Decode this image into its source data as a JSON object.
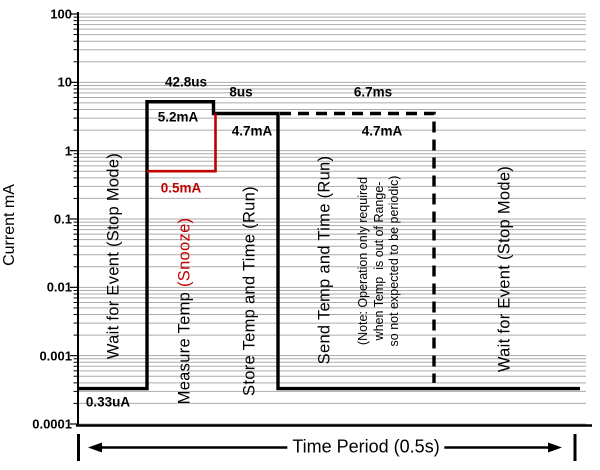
{
  "chart_data": {
    "type": "line",
    "title": "",
    "ylabel": "Current mA",
    "yscale": "log",
    "ylim": [
      0.0001,
      100
    ],
    "ytick_labels": [
      "100",
      "10",
      "1",
      "0.1",
      "0.01",
      "0.001",
      "0.0001"
    ],
    "grid": "horizontal log minor gridlines, gray",
    "legend": "none",
    "period_label": "Time Period (0.5s)",
    "colors": {
      "primary": "#000000",
      "snooze": "#c00000",
      "grid": "#ababab"
    },
    "phases": [
      {
        "label": "Wait for Event (Stop Mode)",
        "current_label": "0.33uA",
        "current_mA": 0.00033
      },
      {
        "label_black": "Measure Temp ",
        "label_red": "(Snooze)",
        "duration": "42.8us",
        "current_label": "5.2mA",
        "current_mA": 5.2,
        "snooze_label": "0.5mA",
        "snooze_current_mA": 0.5
      },
      {
        "label": "Store Temp and Time (Run)",
        "duration": "8us",
        "current_label": "4.7mA",
        "current_mA": 4.7
      },
      {
        "label": "Send Temp and Time (Run)",
        "duration": "6.7ms",
        "current_label": "4.7mA",
        "current_mA": 4.7,
        "line_style": "dashed",
        "note_lines": [
          "(Note: Operation only required",
          "when Temp  is out of Range-",
          "so not expected to be periodic)"
        ]
      },
      {
        "label": "Wait for Event (Stop Mode)",
        "current_mA": 0.00033
      }
    ],
    "plot": {
      "left": 78,
      "top": 14,
      "right": 586,
      "bottom": 424,
      "axis_right_end": 592,
      "log_top": 2,
      "log_bottom": -4
    },
    "series": [
      {
        "name": "active-current-solid",
        "color": "#000000",
        "width": 3.4,
        "dash": "",
        "points": [
          [
            79,
            0.00033
          ],
          [
            147,
            0.00033
          ],
          [
            147,
            5.2
          ],
          [
            213.5,
            5.2
          ],
          [
            213.5,
            3.5
          ],
          [
            278,
            3.5
          ],
          [
            278,
            0.00033
          ],
          [
            580,
            0.00033
          ]
        ]
      },
      {
        "name": "send-current-dashed",
        "color": "#000000",
        "width": 3.4,
        "dash": "11 7",
        "points": [
          [
            280,
            3.5
          ],
          [
            434,
            3.5
          ],
          [
            434,
            0.0004
          ]
        ]
      },
      {
        "name": "snooze-current-red",
        "color": "#c00000",
        "width": 2.6,
        "dash": "",
        "points": [
          [
            215.5,
            3.5
          ],
          [
            215.5,
            0.5
          ],
          [
            147,
            0.5
          ]
        ]
      }
    ],
    "period_bracket": {
      "x1": 78.5,
      "x2": 575,
      "arrow_x1": 88,
      "arrow_x2": 562,
      "y": 447.5,
      "tick_top": 434,
      "tick_bottom": 461
    }
  }
}
